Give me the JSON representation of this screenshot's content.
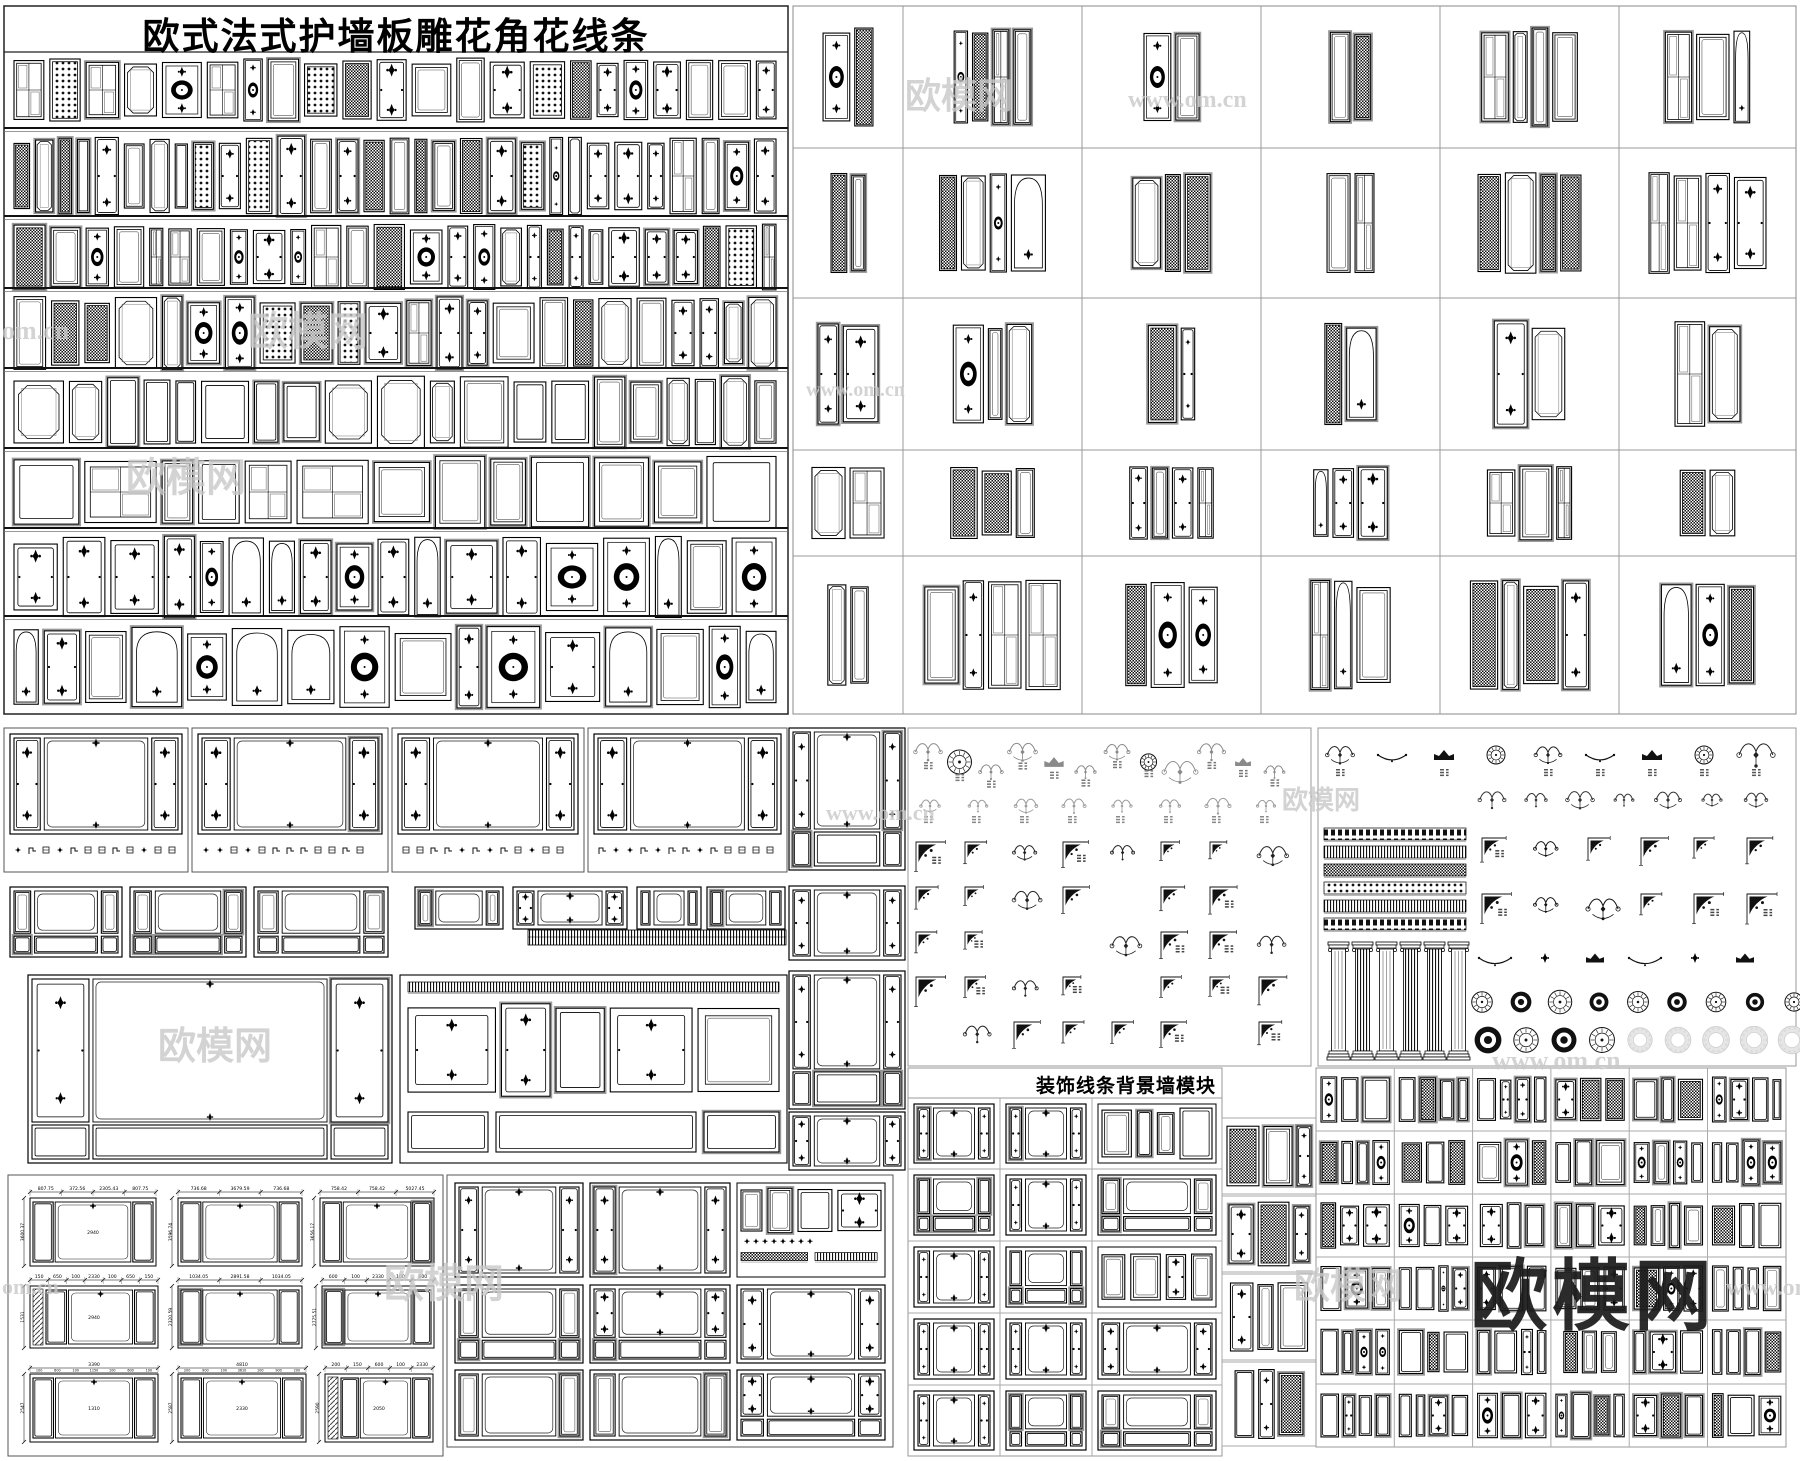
{
  "title": "欧式法式护墙板雕花角花线条",
  "sections": {
    "decor_modules_title": "装饰线条背景墙模块"
  },
  "watermarks": {
    "big": {
      "text": "欧模网"
    },
    "light": [
      {
        "text": "欧模网",
        "x": 905,
        "y": 78,
        "size": 36
      },
      {
        "text": "www.om.cn",
        "x": 1128,
        "y": 88,
        "size": 24
      },
      {
        "text": "欧模网",
        "x": 248,
        "y": 312,
        "size": 40
      },
      {
        "text": "om.cn",
        "x": 2,
        "y": 318,
        "size": 26
      },
      {
        "text": "欧模网",
        "x": 126,
        "y": 458,
        "size": 40
      },
      {
        "text": "www.om.cn",
        "x": 806,
        "y": 380,
        "size": 20
      },
      {
        "text": "www.om.cn",
        "x": 826,
        "y": 802,
        "size": 22
      },
      {
        "text": "欧模网",
        "x": 1282,
        "y": 788,
        "size": 26
      },
      {
        "text": "欧模网",
        "x": 158,
        "y": 1028,
        "size": 38
      },
      {
        "text": "欧模网",
        "x": 384,
        "y": 1264,
        "size": 40
      },
      {
        "text": "欧模网",
        "x": 1294,
        "y": 1268,
        "size": 36
      },
      {
        "text": "www.om.cn",
        "x": 1492,
        "y": 1048,
        "size": 26
      },
      {
        "text": "www.om",
        "x": 1726,
        "y": 1276,
        "size": 24
      },
      {
        "text": "om.cn",
        "x": 2,
        "y": 1276,
        "size": 22
      }
    ]
  },
  "colors": {
    "line": "#000000",
    "grid_border": "#9a9a9a",
    "watermark_light": "#c9c9c9",
    "watermark_big": "#1b1b1b",
    "motif_gray": "#8a8a8a",
    "background": "#ffffff"
  },
  "structure": {
    "panel_rows": [
      22,
      30,
      27,
      23,
      20,
      13,
      18,
      16
    ],
    "top_right_grid": {
      "cols": 6,
      "rows": 5
    },
    "decor_grid": {
      "cols": 3,
      "rows": 5
    },
    "bottom_right_grid": {
      "cols": 6,
      "rows": 6
    },
    "bottom_middle_grid": {
      "cols": 3,
      "rows": 3
    },
    "ornament_corner_grid": {
      "rows": 5,
      "cols": 8
    }
  },
  "dim_drawings": [
    {
      "top": [
        "807.75",
        "372.56",
        "2305.43",
        "807.75"
      ],
      "left": "3600.37",
      "inner": "2940"
    },
    {
      "top": [
        "736.68",
        "3679.59",
        "736.68"
      ],
      "left": "3596.74",
      "inner": ""
    },
    {
      "top": [
        "758.42",
        "758.42",
        "5027.45"
      ],
      "left": "3656.17",
      "inner": ""
    },
    {
      "top": [
        "150",
        "650",
        "100",
        "2330",
        "100",
        "650",
        "150"
      ],
      "left": "1531",
      "inner": "2940",
      "hatch": true
    },
    {
      "top": [
        "1034.05",
        "2891.58",
        "1034.05"
      ],
      "left": "2320.59",
      "inner": ""
    },
    {
      "top": [
        "600",
        "100",
        "2330",
        "100",
        "600"
      ],
      "left": "2775.51",
      "inner": ""
    },
    {
      "top": [
        "3390"
      ],
      "sub": [
        "100",
        "600",
        "100",
        "1150",
        "100",
        "600",
        "100"
      ],
      "left": "2547",
      "inner": "1310"
    },
    {
      "top": [
        "4810"
      ],
      "sub": [
        "200",
        "900",
        "100",
        "3610",
        "100",
        "900",
        "200"
      ],
      "left": "2587",
      "inner": "2330"
    },
    {
      "top": [
        "200",
        "150",
        "600",
        "100",
        "2330"
      ],
      "left": "2590",
      "inner": "2050",
      "hatch": true
    }
  ]
}
